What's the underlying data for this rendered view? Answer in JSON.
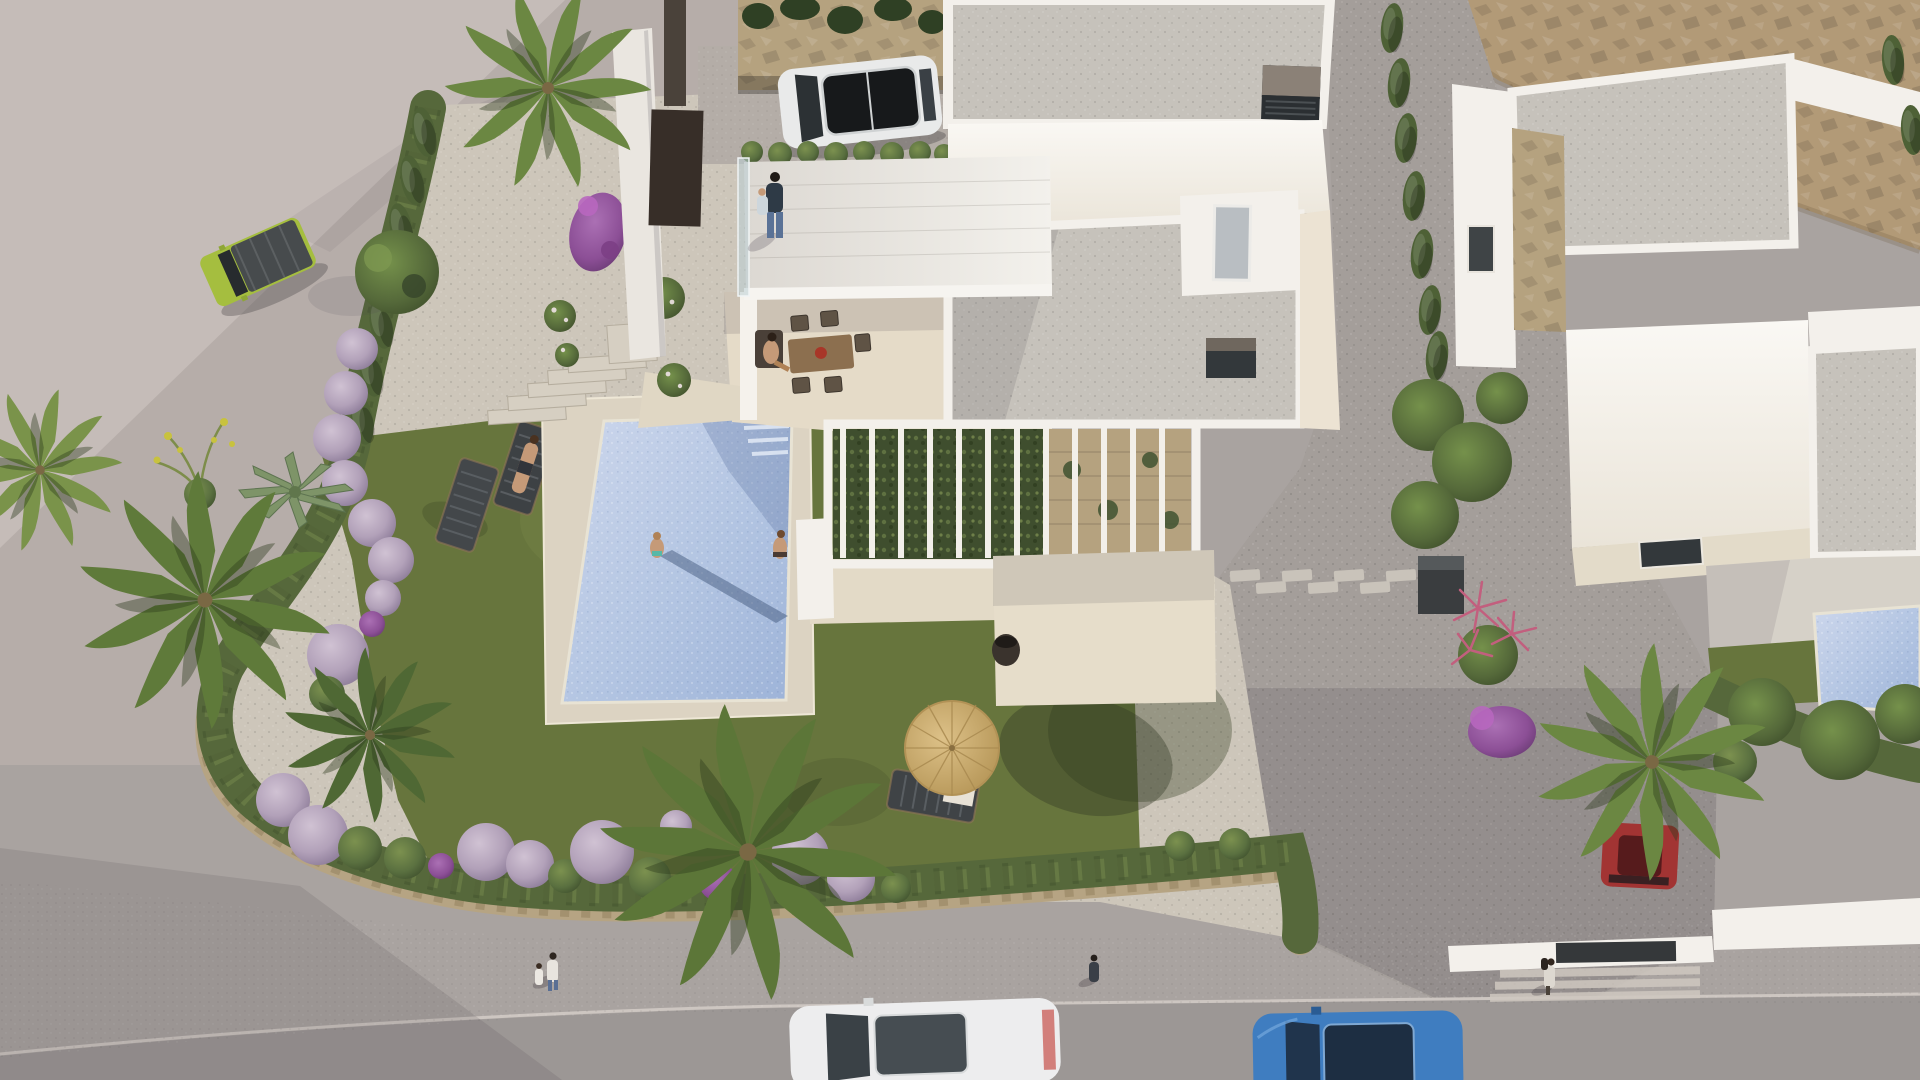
{
  "scene": {
    "type": "aerial-3d-architectural-render",
    "setting": "Bird's-eye render of a modern white villa with pool and garden on a street corner, a neighbouring white villa to the right and a rocky tan slope at the top right",
    "lighting": "low sun from upper right, long shadows toward lower left"
  },
  "colors": {
    "plaza": "#b6ada9",
    "plaza_light": "#c5bcb8",
    "sidewalk": "#a9a3a0",
    "road": "#9c9795",
    "curb": "#cdc6c1",
    "rock": "#b29a77",
    "driveway": "#a49e9a",
    "gravel": "#cdc6ba",
    "lawn": "#67753d",
    "deck": "#dcd3c2",
    "pool_light": "#c9d4ea",
    "pool_mid": "#a9bede",
    "villa_white": "#f3f0eb",
    "villa_sun": "#f8f6f1",
    "villa_cream": "#ece3d3",
    "roof_gravel": "#c6c2bb",
    "pergola_green": "#3f4e2e",
    "pergola_stone": "#b5a27f",
    "terrace_floor": "#e7e4df",
    "stone_wall": "#b6a483",
    "hedge": "#56683b",
    "cypress": "#4e6136",
    "tree": "#55693a",
    "palm": "#6b8742",
    "bush_lilac": "#b3a2ba",
    "bush_green": "#5a7040",
    "bougainvillea": "#a14fa6",
    "pink_plant": "#c25f7e",
    "agave": "#7e9468",
    "jeep_green": "#a5be3f",
    "suv_white": "#e9eaea",
    "car_white": "#ededee",
    "car_blue": "#3f7dc0",
    "car_red": "#a23433",
    "parasol": "#cead72",
    "skin": "#c59a78",
    "glass": "#bcd0d6",
    "ac_dark": "#33383b",
    "pot": "#3a332d"
  },
  "objects": {
    "buildings": [
      {
        "name": "main-villa",
        "features": [
          "flat gravel roofs",
          "roof terrace with glass balustrade",
          "carport with stone feature wall",
          "white slat pergola over climbing plants",
          "stair bulkhead with skylight",
          "two rooftop AC units"
        ]
      },
      {
        "name": "neighbor-villa",
        "features": [
          "flat gravel roofs",
          "stone clad wall",
          "private blue-tile pool",
          "terrace slabs",
          "street entrance with dark gate and steps"
        ]
      }
    ],
    "vehicles": [
      {
        "name": "green-jeep",
        "location": "plaza top left"
      },
      {
        "name": "white-suv",
        "location": "carport"
      },
      {
        "name": "white-car",
        "location": "street bottom center"
      },
      {
        "name": "blue-car",
        "location": "street bottom right"
      },
      {
        "name": "red-car",
        "location": "neighbor driveway under palm"
      }
    ],
    "people": [
      {
        "name": "man-holding-child",
        "location": "roof terrace"
      },
      {
        "name": "woman-at-dining-table",
        "location": "front terrace"
      },
      {
        "name": "woman-on-lounger",
        "location": "lawn beside pool"
      },
      {
        "name": "woman-standing-in-pool",
        "location": "pool"
      },
      {
        "name": "woman-sitting-on-pool-edge",
        "location": "pool corner"
      },
      {
        "name": "adult-and-child-walking",
        "location": "sidewalk left"
      },
      {
        "name": "pedestrian",
        "location": "sidewalk center"
      },
      {
        "name": "pedestrian-with-bag",
        "location": "sidewalk right"
      }
    ],
    "furniture": [
      {
        "name": "straw-parasol",
        "location": "front lawn"
      },
      {
        "name": "sun-loungers",
        "count": 3
      },
      {
        "name": "dining-table-with-chairs",
        "seats": 6
      },
      {
        "name": "black-planter-pot",
        "location": "courtyard"
      }
    ],
    "vegetation": [
      {
        "name": "fan-palms",
        "count": 5
      },
      {
        "name": "lilac-ball-bushes",
        "count": 18
      },
      {
        "name": "green-ball-bushes",
        "count": 8
      },
      {
        "name": "cypress-hedgerows",
        "count": 2
      },
      {
        "name": "perimeter-hedge-with-stone-wall"
      },
      {
        "name": "bougainvillea",
        "count": 2
      },
      {
        "name": "agave"
      },
      {
        "name": "pink-dracaena"
      },
      {
        "name": "rose-bushes"
      },
      {
        "name": "yellow-flower-plant"
      }
    ],
    "hardscape": [
      {
        "name": "swimming-pool",
        "people_in_or_on": 2
      },
      {
        "name": "travertine-pool-deck"
      },
      {
        "name": "garden-steps",
        "count": 5
      },
      {
        "name": "stepping-stone-path"
      },
      {
        "name": "gravel-driveway"
      },
      {
        "name": "street-with-sidewalk"
      }
    ]
  }
}
